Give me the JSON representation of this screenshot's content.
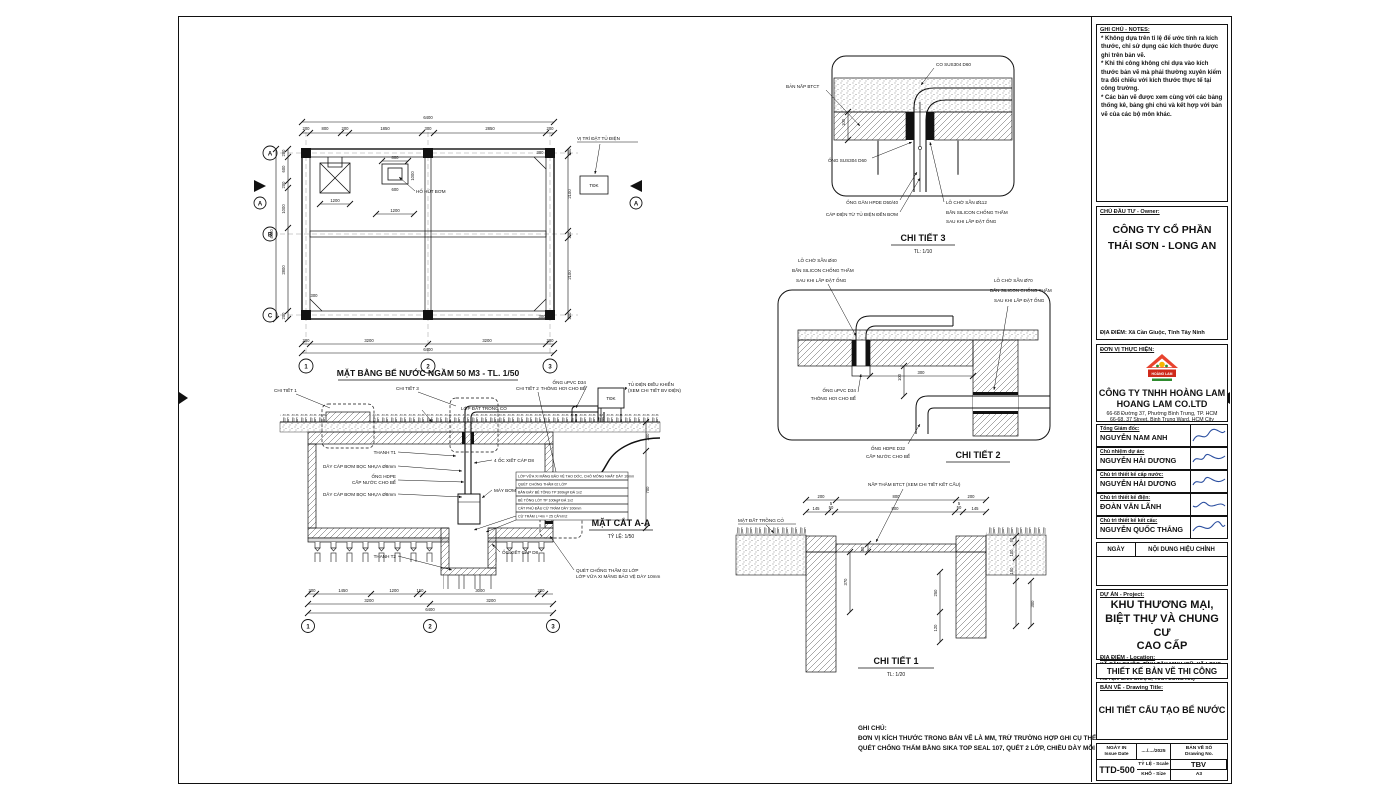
{
  "plan": {
    "title": "MẶT BẰNG BỂ NƯỚC NGẦM 50 M3 - TL. 1/50",
    "rows": [
      "A",
      "B",
      "C"
    ],
    "cols": [
      "1",
      "2",
      "3"
    ],
    "section_mark": "A",
    "pump_pit_label": "HỐ HÚT BƠM",
    "panel_label": "VỊ TRÍ ĐẶT TỦ ĐIỆN",
    "panel_tag": "TĐK",
    "dims": {
      "total": "6400",
      "top": [
        "200",
        "800",
        "200",
        "1850",
        "300",
        "2850",
        "200"
      ],
      "left_total": "4400",
      "left": [
        "200",
        "600",
        "200",
        "1000",
        "2800",
        "200"
      ],
      "right": [
        "200",
        "2100",
        "200",
        "2100",
        "200"
      ],
      "bottom": [
        "200",
        "3200",
        "3200",
        "200"
      ],
      "bottom_total": "6400",
      "chamfer": "300",
      "d800": "800",
      "d600": "600",
      "d1000": "1000",
      "d1200a": "1200",
      "d1200b": "1200"
    }
  },
  "section": {
    "title": "MẶT CẮT A-A",
    "scale": "TỶ LỆ: 1/50",
    "callout1": "CHI TIẾT 1",
    "callout2": "CHI TIẾT 2",
    "callout3": "CHI TIẾT 3",
    "labels": {
      "grass": "LỚP ĐẤT TRỒNG CỎ",
      "t1": "THANH T1",
      "t2": "THANH T2",
      "cable_a": "DÂY CÁP BƠM BỌC NHỰA Ø8mm",
      "cable_b": "DÂY CÁP BƠM BỌC NHỰA Ø8mm",
      "pipe1": "ỐNG HDPE",
      "pipe2": "CẤP NƯỚC CHO BỂ",
      "clamp4": "4 ỐC XIẾT CÁP D8",
      "clamp": "ỐC XIẾT CÁP D8",
      "pump": "MÁY BƠM",
      "wp1": "QUÉT CHỐNG THẤM 02 LỚP",
      "wp2": "LỚP VỮA XI MĂNG BẢO VỆ DÀY 10mm",
      "panel1": "TỦ ĐIỆN ĐIỀU KHIỂN",
      "panel2": "(XEM CHI TIẾT BV ĐIỆN)",
      "panel_tag": "TĐK",
      "vent1": "ỐNG uPVC D34",
      "vent2": "THÔNG HƠI CHO BỂ"
    },
    "stack": [
      "LỚP VỮA XI MĂNG BẢO VỆ TẠO DỐC, CHỖ MỎNG NHẤT DÀY 10mm",
      "QUÉT CHỐNG THẤM 02 LỚP",
      "BẢN ĐÁY BÊ TÔNG TP 300kg# ĐÁ 1x2",
      "BÊ TÔNG LÓT TP 100kg# ĐÁ 1x2",
      "CÁT PHỦ ĐẦU CỪ TRÀM DÀY 100mm",
      "CỪ TRÀM L=4m = 25 CÂY/m2"
    ],
    "dims": {
      "chain": [
        "200",
        "1450",
        "1200",
        "150",
        "3000",
        "200"
      ],
      "mid": [
        "3200",
        "3200"
      ],
      "total": "6400",
      "right": [
        "300",
        "700"
      ]
    },
    "bubbles": [
      "1",
      "2",
      "3"
    ]
  },
  "detail3": {
    "title": "CHI TIẾT 3",
    "scale": "TL: 1/10",
    "labels": {
      "elbow": "CO SUS304 D60",
      "slab": "BẢN NẮP BTCT",
      "pipe": "ỐNG SUS304 D60",
      "conduit": "ỐNG GÂN HPDE D50/40",
      "cable": "CÁP ĐIỆN TỪ TỦ ĐIỆN ĐẾN BƠM",
      "hole": "LỖ CHỜ SẴN Ø112",
      "sil1": "BẮN SILICON CHỐNG THẤM",
      "sil2": "SAU KHI LẮP ĐẶT ỐNG"
    },
    "dim100": "100"
  },
  "detail2": {
    "title": "CHI TIẾT 2",
    "labels": {
      "hole40": "LỖ CHỜ SẴN Ø40",
      "sil40a": "BẮN SILICON CHỐNG THẤM",
      "sil40b": "SAU KHI LẮP ĐẶT ỐNG",
      "hole70": "LỖ CHỜ SẴN Ø70",
      "sil70a": "BẮN SILICON CHỐNG THẤM",
      "sil70b": "SAU KHI LẮP ĐẶT ỐNG",
      "vent1": "ỐNG uPVC D34",
      "vent2": "THÔNG HƠI CHO BỂ",
      "fill1": "ỐNG HDPE D32",
      "fill2": "CẤP NƯỚC CHO BỂ"
    },
    "dims": {
      "d300": "300",
      "d100": "100"
    }
  },
  "detail1": {
    "title": "CHI TIẾT 1",
    "scale": "TL: 1/20",
    "labels": {
      "cover": "NẮP THĂM BTCT (XEM CHI TIẾT KẾT CẤU)",
      "ground": "MẶT ĐẤT TRỒNG CỎ"
    },
    "dims": {
      "top": [
        "200",
        "800",
        "200"
      ],
      "row2": [
        "145",
        "50",
        "800",
        "50",
        "145"
      ],
      "five": "5",
      "d80": "80",
      "d370": "370",
      "d250": "250",
      "d120": "120",
      "right": [
        "50",
        "100",
        "150",
        "300"
      ]
    }
  },
  "footnote": {
    "title": "GHI CHÚ:",
    "line1": "ĐƠN VỊ KÍCH THƯỚC TRONG BẢN VẼ LÀ MM, TRỪ TRƯỜNG HỢP GHI CỤ THỂ.",
    "line2": "QUÉT CHỐNG THẤM BẰNG SIKA TOP SEAL 107, QUÉT 2 LỚP, CHIỀU DÀY MỖI LỚP LÀ 1MM."
  },
  "titleblock": {
    "notes": {
      "title": "GHI CHÚ - NOTES:",
      "b1": "*   Không dựa trên tỉ lệ để ước tính ra kích thước, chỉ sử dụng các kích thước được ghi trên bản vẽ.",
      "b2": "*   Khi thi công không chỉ dựa vào kích thước bản vẽ mà phải thường xuyên kiểm tra đối chiếu với kích thước thực tế tại công trường.",
      "b3": "*   Các bản vẽ được xem cùng với các bảng thống kê, bảng ghi chú và kết hợp với bản vẽ của các bộ môn khác."
    },
    "owner": {
      "label": "CHỦ ĐẦU TƯ - Owner:",
      "name1": "CÔNG TY CỔ PHẦN",
      "name2": "THÁI SƠN - LONG AN",
      "location": "ĐỊA ĐIỂM: Xã Cần Giuộc, Tỉnh Tây Ninh"
    },
    "executor": {
      "label": "ĐƠN VỊ THỰC HIỆN:",
      "logo_text": "HOÀNG LAM",
      "name_vn": "CÔNG TY TNHH HOÀNG LAM",
      "name_en": "HOANG LAM CO.LTD",
      "addr_vn": "66-68 Đường 37, Phường Bình Trưng, TP. HCM",
      "addr_en": "66-68, 37 Street, Binh Trung Ward, HCM City"
    },
    "roles": [
      {
        "role": "Tổng Giám đốc:",
        "name": "NGUYỄN NAM ANH"
      },
      {
        "role": "Chủ nhiệm dự án:",
        "name": "NGUYỄN HẢI DƯƠNG"
      },
      {
        "role": "Chủ trì thiết kế cấp nước:",
        "name": "NGUYỄN HẢI DƯƠNG"
      },
      {
        "role": "Chủ trì thiết kế điện:",
        "name": "ĐOÀN VĂN LÃNH"
      },
      {
        "role": "Chủ trì thiết kế kết cấu:",
        "name": "NGUYỄN QUỐC THẮNG"
      }
    ],
    "revision": {
      "date": "NGÀY",
      "content": "NỘI DUNG HIỆU CHỈNH"
    },
    "project": {
      "label": "DỰ ÁN - Project:",
      "t1": "KHU THƯƠNG MẠI,",
      "t2": "BIỆT THỰ VÀ CHUNG CƯ",
      "t3": "CAO CẤP",
      "loc_label": "ĐỊA ĐIỂM - Location:",
      "loc1": "XÃ CẦN GIUỘC, TỈNH TÂY NINH (CŨ: XÃ LONG HẬU,",
      "loc2": "HUYỆN CẦN GIUỘC, TỈNH LONG AN)"
    },
    "stage": "THIẾT KẾ BẢN VẼ THI CÔNG",
    "drawing": {
      "label": "BẢN VẼ - Drawing Title:",
      "title": "CHI TIẾT CẤU TẠO BỂ NƯỚC"
    },
    "issue": {
      "date_label": "NGÀY IN",
      "date_label_en": "Issue Date",
      "date_value": "..../..../2025",
      "no_label": "BẢN VẼ SỐ",
      "no_label_en": "Drawing No.",
      "scale_label": "TỶ LỆ - Scale",
      "scale_value": "TBV",
      "size_label": "KHỔ - Size",
      "size_value": "A3",
      "number": "TTD-500"
    }
  }
}
